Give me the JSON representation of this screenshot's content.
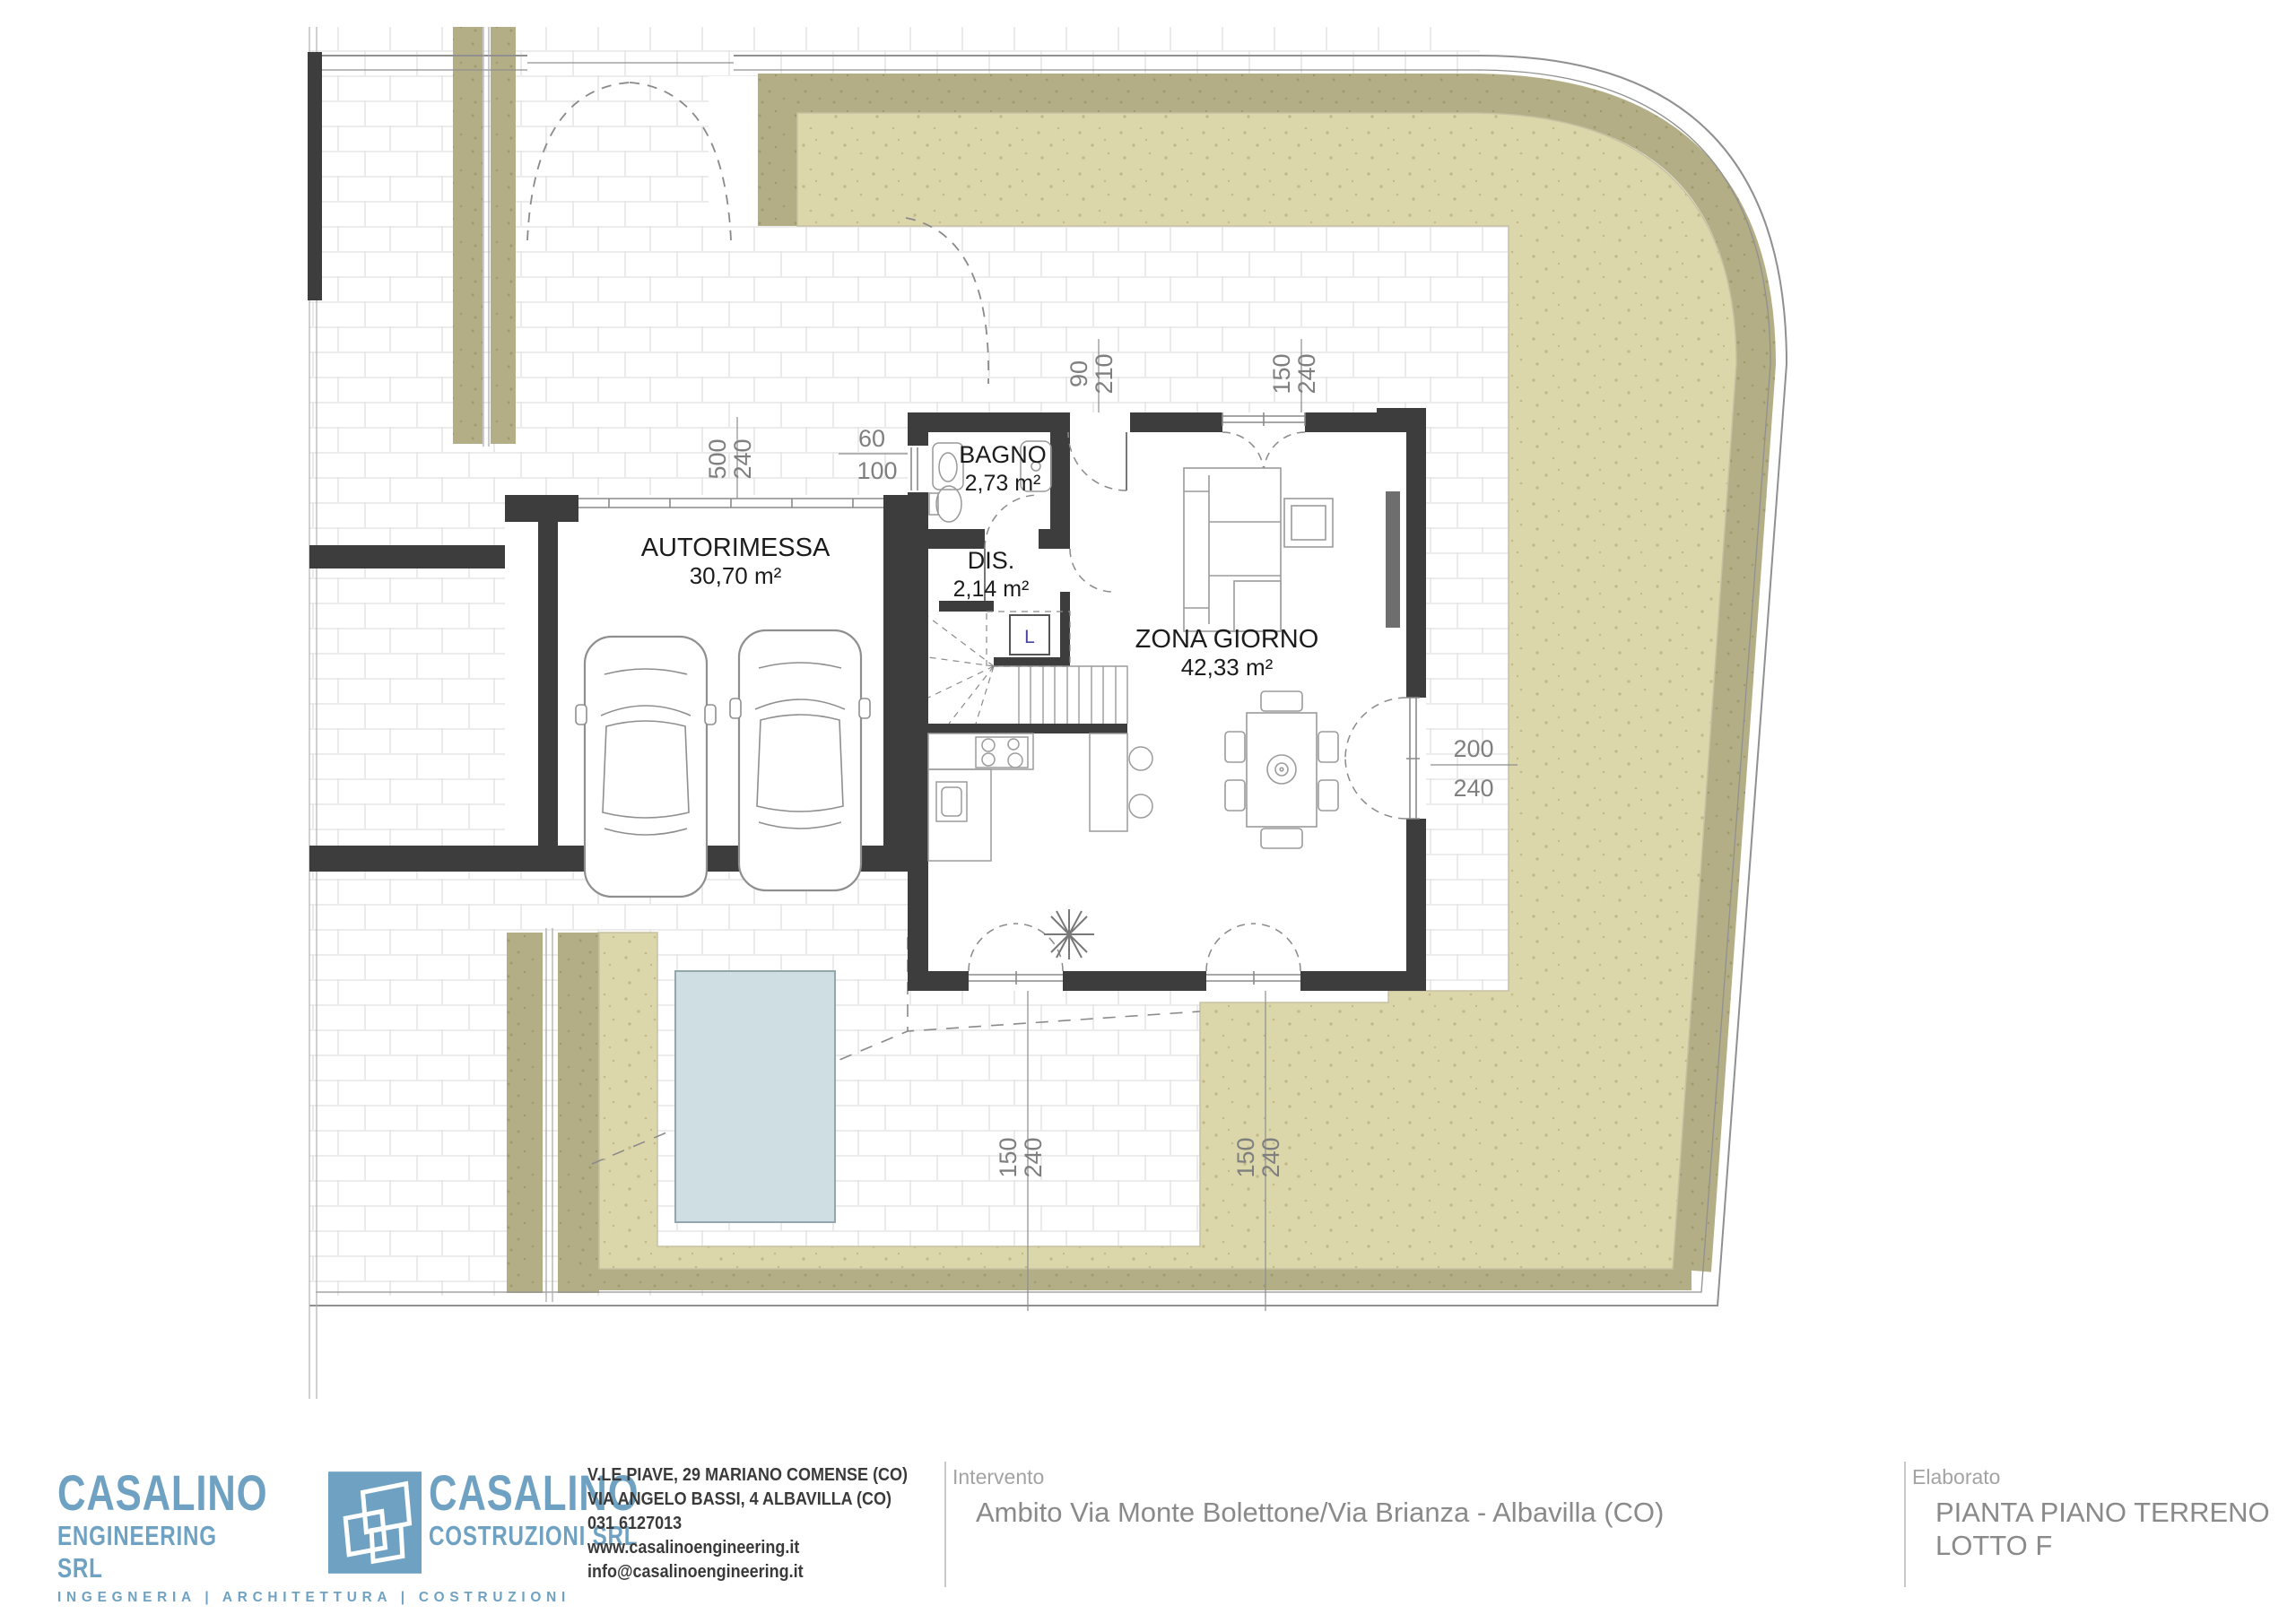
{
  "plan": {
    "rooms": [
      {
        "name": "AUTORIMESSA",
        "area": "30,70 m²"
      },
      {
        "name": "BAGNO",
        "area": "2,73 m²"
      },
      {
        "name": "DIS.",
        "area": "2,14 m²"
      },
      {
        "name": "ZONA GIORNO",
        "area": "42,33 m²"
      }
    ],
    "elevator_label": "L",
    "dimensions": {
      "garage_door": [
        "500",
        "240"
      ],
      "bagno_window": [
        "60",
        "100"
      ],
      "entry_door": [
        "90",
        "210"
      ],
      "north_window": [
        "150",
        "240"
      ],
      "east_window": [
        "200",
        "240"
      ],
      "south_window_left": [
        "150",
        "240"
      ],
      "south_window_right": [
        "150",
        "240"
      ]
    },
    "colors": {
      "wall": "#3d3d3d",
      "lawn": "#dcd7ab",
      "hedge": "#b3ae85",
      "pool": "#cfdee3",
      "paving_joint": "#e6e6e6"
    }
  },
  "titleblock": {
    "brand_color": "#6fa2c2",
    "company_left": {
      "line1": "CASALINO",
      "line2": "ENGINEERING SRL"
    },
    "company_right": {
      "line1": "CASALINO",
      "line2": "COSTRUZIONI SRL"
    },
    "tagline": "INGEGNERIA   |   ARCHITETTURA   |   COSTRUZIONI",
    "contact": [
      "V.LE PIAVE, 29 MARIANO COMENSE (CO)",
      "VIA ANGELO BASSI, 4 ALBAVILLA (CO)",
      "031  6127013",
      "www.casalinoengineering.it",
      "info@casalinoengineering.it"
    ],
    "intervento_label": "Intervento",
    "intervento_value": "Ambito Via Monte Bolettone/Via Brianza - Albavilla (CO)",
    "elaborato_label": "Elaborato",
    "elaborato_line1": "PIANTA PIANO TERRENO",
    "elaborato_line2": "LOTTO F"
  }
}
